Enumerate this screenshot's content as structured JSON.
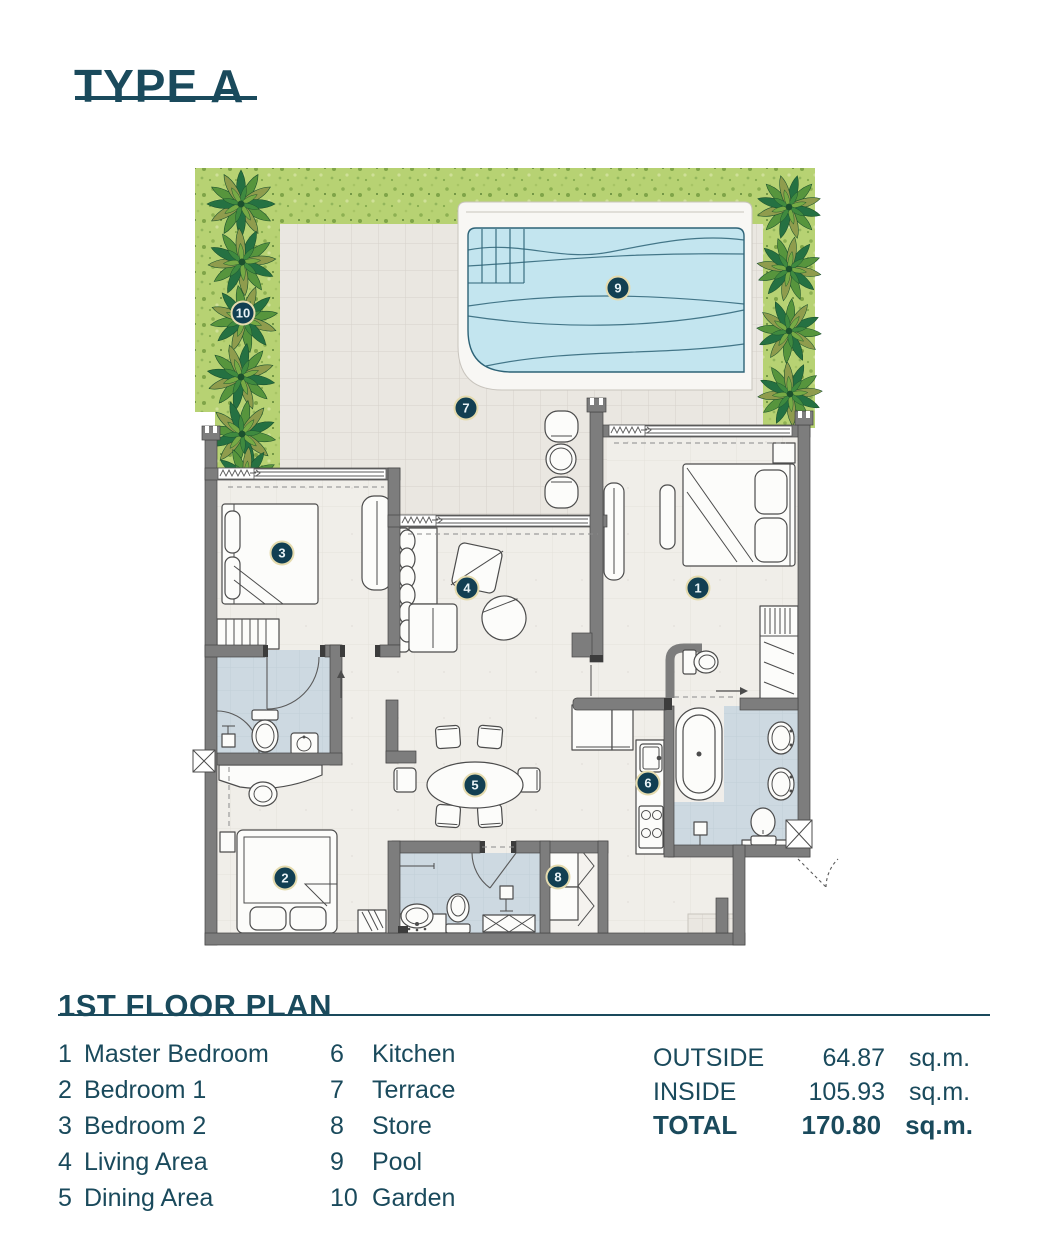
{
  "title": "TYPE A",
  "plan_heading": "1ST FLOOR PLAN",
  "legend": {
    "items": [
      {
        "num": "1",
        "label": "Master Bedroom"
      },
      {
        "num": "2",
        "label": "Bedroom 1"
      },
      {
        "num": "3",
        "label": "Bedroom 2"
      },
      {
        "num": "4",
        "label": "Living Area"
      },
      {
        "num": "5",
        "label": "Dining Area"
      },
      {
        "num": "6",
        "label": "Kitchen"
      },
      {
        "num": "7",
        "label": "Terrace"
      },
      {
        "num": "8",
        "label": "Store"
      },
      {
        "num": "9",
        "label": "Pool"
      },
      {
        "num": "10",
        "label": "Garden"
      }
    ]
  },
  "areas": {
    "rows": [
      {
        "label": "OUTSIDE",
        "value": "64.87",
        "unit": "sq.m."
      },
      {
        "label": "INSIDE",
        "value": "105.93",
        "unit": "sq.m."
      },
      {
        "label": "TOTAL",
        "value": "170.80",
        "unit": "sq.m."
      }
    ]
  },
  "colors": {
    "accent": "#1a4a5c",
    "marker": "#123f52",
    "marker-ring": "#e5dbae",
    "wall": "#7d7d7d",
    "grass": "#b7d273",
    "water": "#c3e5ef",
    "terrace": "#eae7e1",
    "floor": "#f0eee9",
    "bath-floor": "#cdd9e1"
  }
}
